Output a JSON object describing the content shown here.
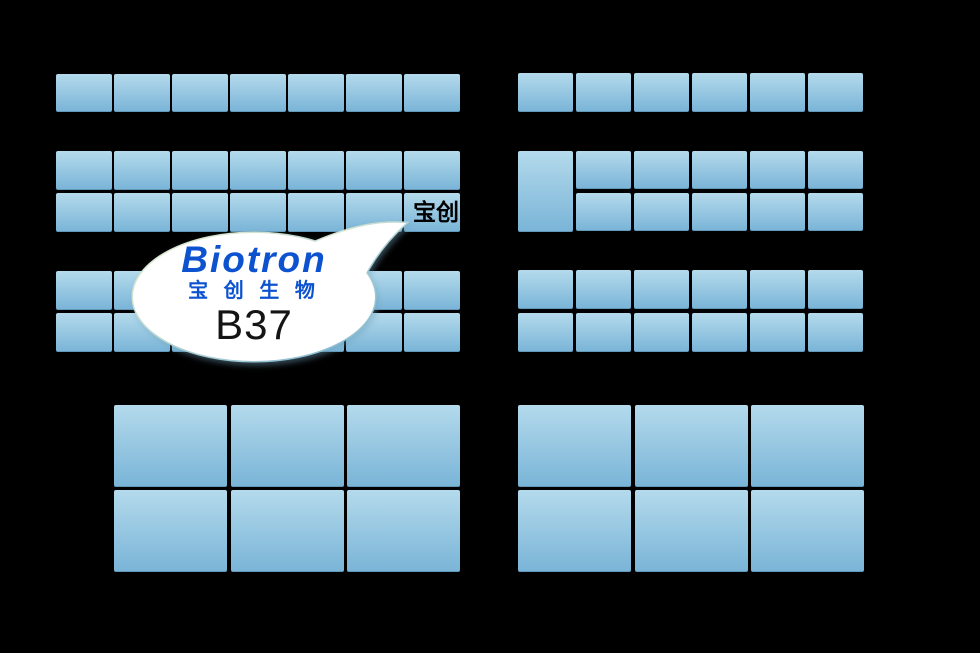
{
  "background": "#000000",
  "booth": {
    "gradient_top": "#b4daec",
    "gradient_bottom": "#79b4d7",
    "labeled_booth_text": "宝创"
  },
  "callout": {
    "brand_en": "Biotron",
    "brand_cn": "宝 创 生 物",
    "booth_number": "B37",
    "text_blue": "#0d53d0",
    "number_color": "#141414",
    "fill": "#ffffff",
    "edge_light": "#eaf0d0",
    "edge_dark": "#7fb7d2"
  },
  "floorplan": {
    "sections": [
      {
        "id": "top-left-row",
        "x": 56,
        "y": 74,
        "cols": 7,
        "rows": 1,
        "cw": 56,
        "ch": 38,
        "px": 58,
        "py": 42
      },
      {
        "id": "top-right-row",
        "x": 518,
        "y": 73,
        "cols": 6,
        "rows": 1,
        "cw": 55,
        "ch": 39,
        "px": 58,
        "py": 42
      },
      {
        "id": "mid-upper-left",
        "x": 56,
        "y": 151,
        "cols": 7,
        "rows": 2,
        "cw": 56,
        "ch": 39,
        "px": 58,
        "py": 42,
        "labels": [
          {
            "row": 1,
            "col": 6,
            "text": "宝创"
          }
        ]
      },
      {
        "id": "mid-upper-right-tall",
        "x": 518,
        "y": 151,
        "cols": 1,
        "rows": 1,
        "cw": 55,
        "ch": 81,
        "px": 58,
        "py": 84
      },
      {
        "id": "mid-upper-right",
        "x": 576,
        "y": 151,
        "cols": 5,
        "rows": 2,
        "cw": 55,
        "ch": 38,
        "px": 58,
        "py": 42
      },
      {
        "id": "mid-lower-left",
        "x": 56,
        "y": 271,
        "cols": 7,
        "rows": 2,
        "cw": 56,
        "ch": 39,
        "px": 58,
        "py": 42
      },
      {
        "id": "mid-lower-right",
        "x": 518,
        "y": 270,
        "cols": 6,
        "rows": 2,
        "cw": 55,
        "ch": 39,
        "px": 58,
        "py": 43
      },
      {
        "id": "bottom-left",
        "x": 114,
        "y": 405,
        "cols": 3,
        "rows": 2,
        "cw": 113,
        "ch": 82,
        "px": 116.5,
        "py": 85
      },
      {
        "id": "bottom-right",
        "x": 518,
        "y": 405,
        "cols": 3,
        "rows": 2,
        "cw": 113,
        "ch": 82,
        "px": 116.5,
        "py": 85
      }
    ]
  }
}
